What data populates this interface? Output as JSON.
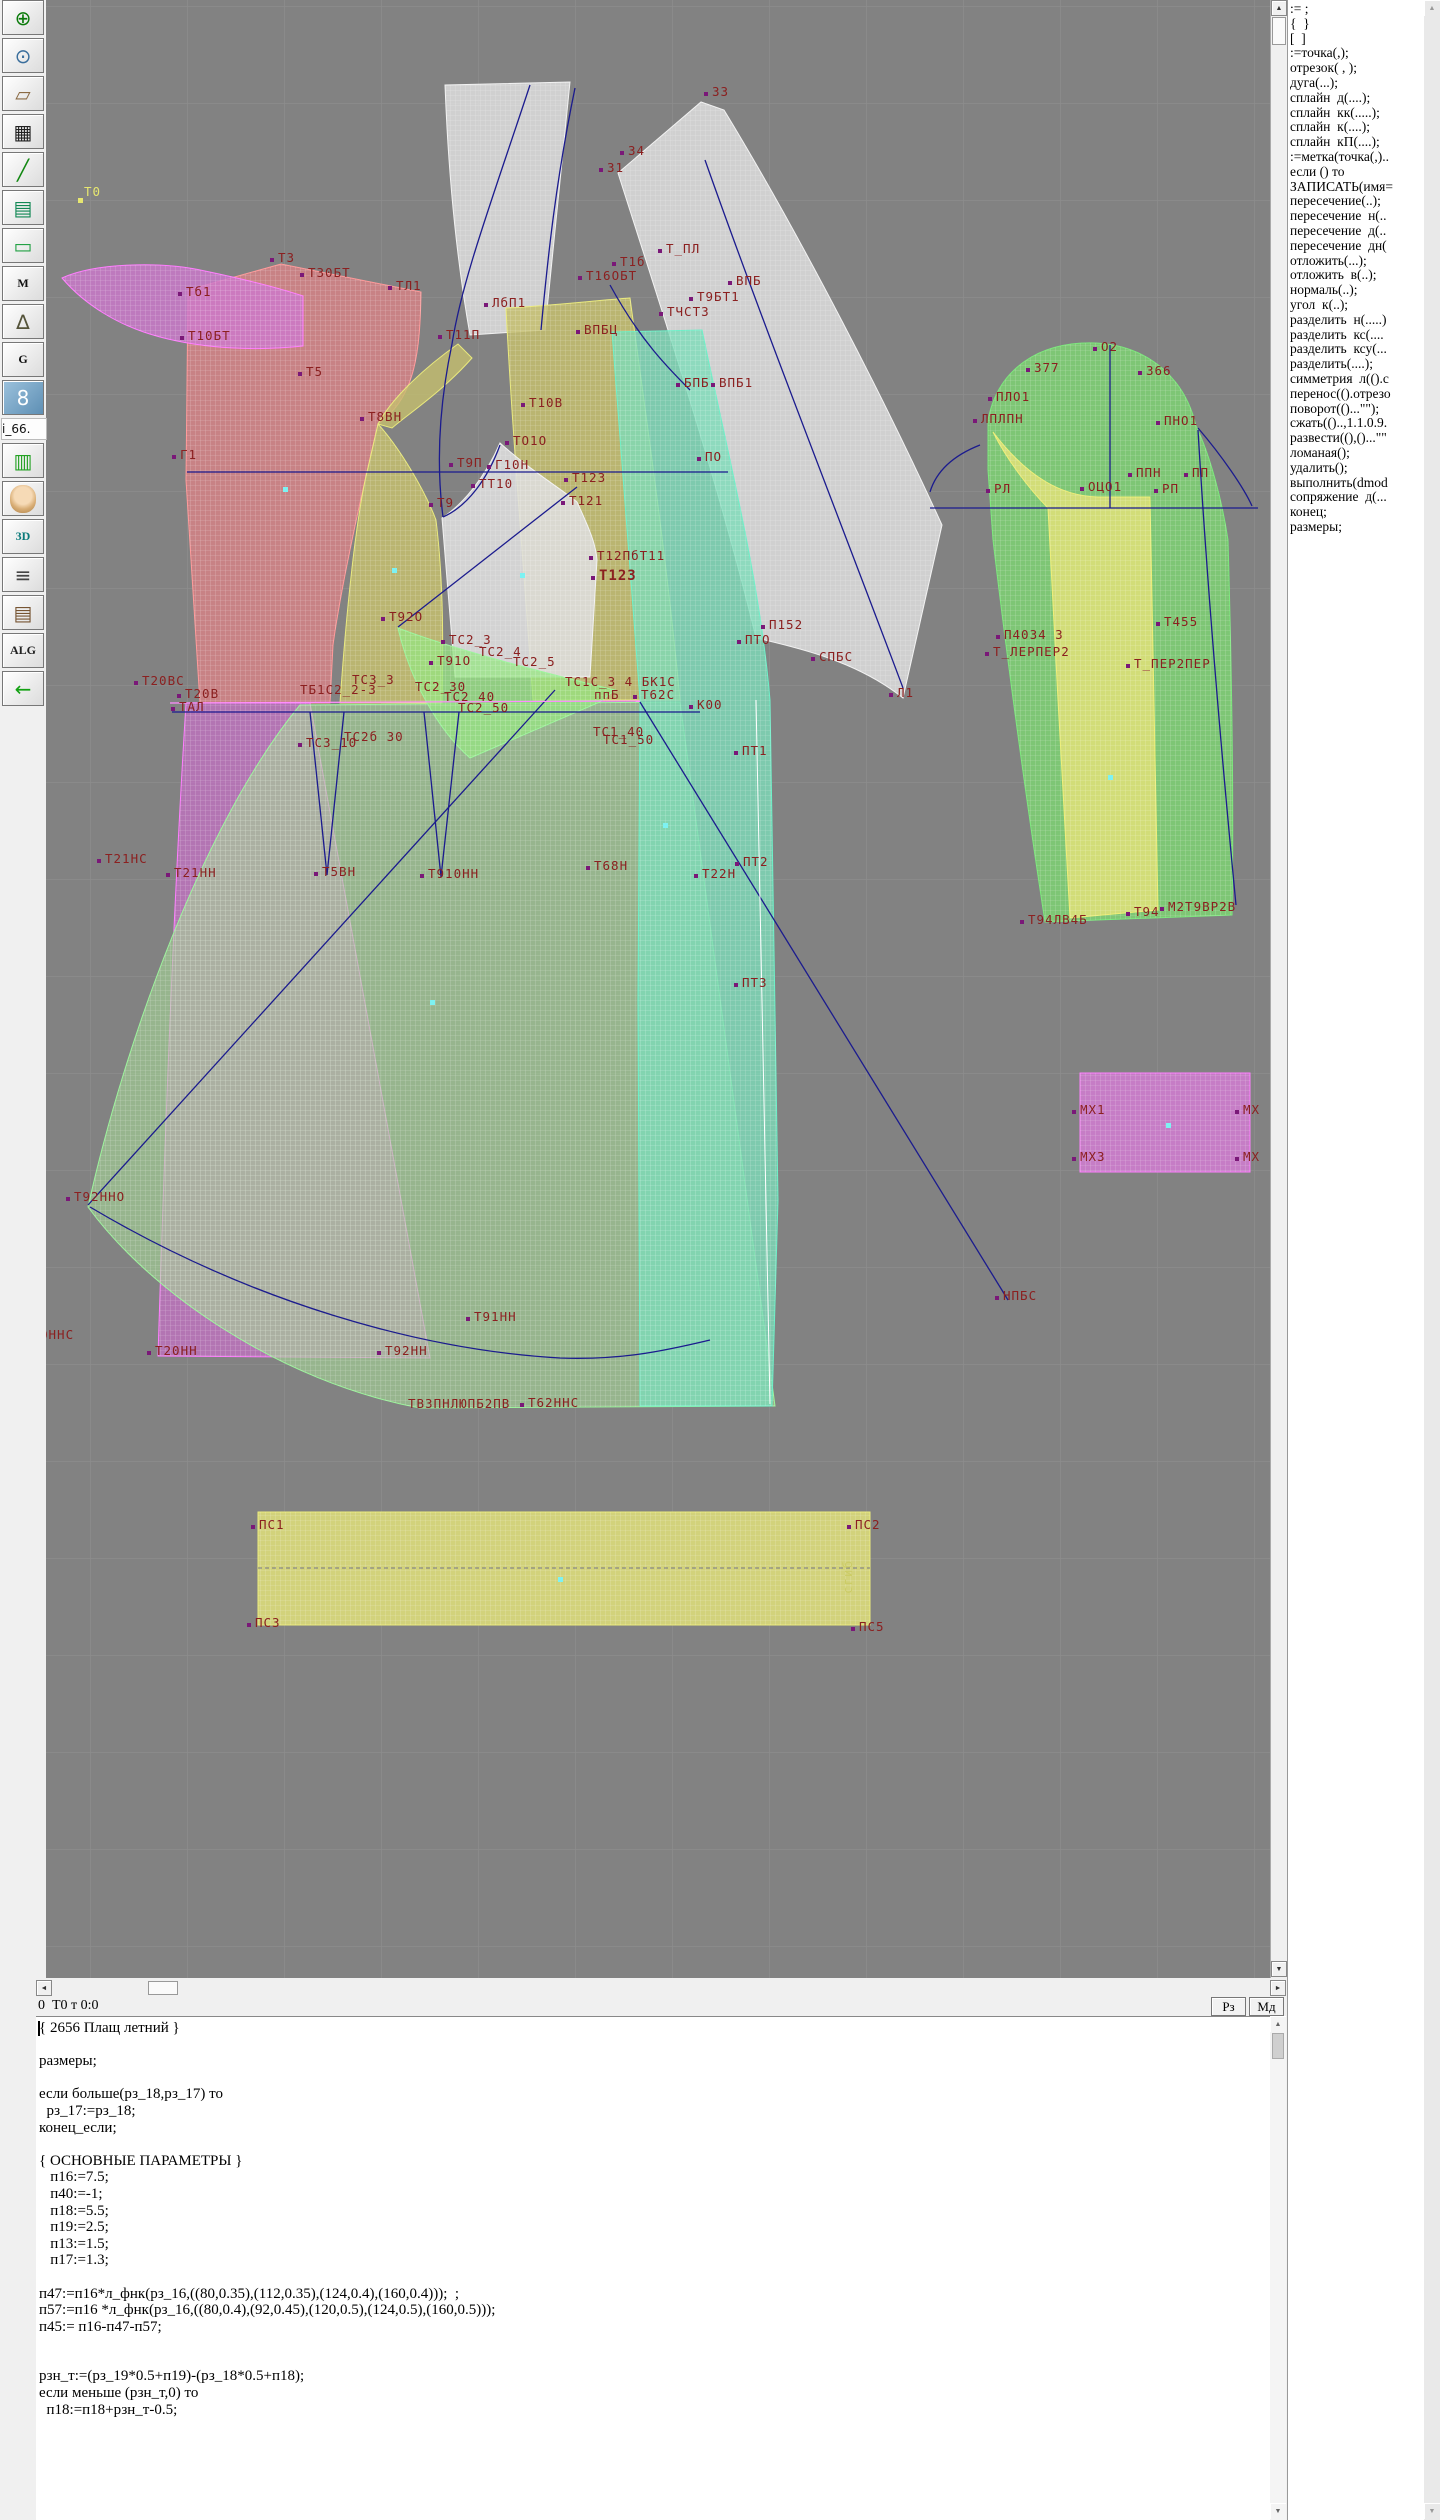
{
  "toolbar": {
    "items": [
      {
        "name": "zoom-in-icon",
        "glyph": "⊕",
        "color": "#0a7a0a"
      },
      {
        "name": "zoom-out-icon",
        "glyph": "⊙",
        "color": "#3a6e9c"
      },
      {
        "name": "label-tag-icon",
        "glyph": "▱",
        "color": "#8a6a44"
      },
      {
        "name": "grid-icon",
        "glyph": "▦",
        "color": "#222222"
      },
      {
        "name": "segment-icon",
        "glyph": "╱",
        "color": "#128812"
      },
      {
        "name": "document-chart-icon",
        "glyph": "▤",
        "color": "#128855"
      },
      {
        "name": "pattern-tag-icon",
        "glyph": "▭",
        "color": "#23a145"
      },
      {
        "name": "m-module-icon",
        "glyph": "M",
        "color": "#111111",
        "serif": true
      },
      {
        "name": "drafting-compass-icon",
        "glyph": "∆",
        "color": "#55543a"
      },
      {
        "name": "g-module-icon",
        "glyph": "G",
        "color": "#111111",
        "serif": true
      },
      {
        "name": "ruler-8-icon",
        "glyph": "8",
        "color": "#ffffff",
        "ruler": true
      },
      {
        "name": "i66-label",
        "text": "i_66."
      },
      {
        "name": "table-icon",
        "glyph": "▥",
        "color": "#23a123"
      },
      {
        "name": "portrait-icon",
        "face": true
      },
      {
        "name": "threed-icon",
        "glyph": "3D",
        "color": "#0a7a7a",
        "small": true
      },
      {
        "name": "text-list-icon",
        "glyph": "≡",
        "color": "#444444"
      },
      {
        "name": "books-icon",
        "glyph": "▤",
        "color": "#775533"
      },
      {
        "name": "alg-icon",
        "glyph": "ALG",
        "color": "#222222",
        "small": true
      },
      {
        "name": "exit-arrow-icon",
        "glyph": "←",
        "color": "#12a112"
      }
    ]
  },
  "canvas": {
    "background": "#828282",
    "grid_color": "#8d8d8d",
    "grid_step": 97,
    "label_color": "#8b2020",
    "marker_color": "#7a1878",
    "cyan_color": "#7df2f2",
    "labels": [
      {
        "t": "Т0",
        "x": 84,
        "y": 196,
        "c": "#e6e670"
      },
      {
        "t": "Т3",
        "x": 278,
        "y": 262,
        "m": 1
      },
      {
        "t": "Т30БТ",
        "x": 308,
        "y": 277,
        "m": 1
      },
      {
        "t": "ТЛ1",
        "x": 396,
        "y": 290,
        "m": 1
      },
      {
        "t": "Тб1",
        "x": 186,
        "y": 296,
        "m": 1
      },
      {
        "t": "Т10БТ",
        "x": 188,
        "y": 340,
        "m": 1
      },
      {
        "t": "Т5",
        "x": 306,
        "y": 376,
        "m": 1
      },
      {
        "t": "33",
        "x": 712,
        "y": 96,
        "m": 1
      },
      {
        "t": "34",
        "x": 628,
        "y": 155,
        "m": 1
      },
      {
        "t": "31",
        "x": 607,
        "y": 172,
        "m": 1
      },
      {
        "t": "Т_ПЛ",
        "x": 666,
        "y": 253,
        "m": 1
      },
      {
        "t": "Т1б",
        "x": 620,
        "y": 266,
        "m": 1
      },
      {
        "t": "Т16ОБТ",
        "x": 586,
        "y": 280,
        "m": 1
      },
      {
        "t": "ВПБ",
        "x": 736,
        "y": 285,
        "m": 1
      },
      {
        "t": "Т9БТ1",
        "x": 697,
        "y": 301,
        "m": 1
      },
      {
        "t": "ТЧСТ3",
        "x": 667,
        "y": 316,
        "m": 1
      },
      {
        "t": "ЛбП1",
        "x": 492,
        "y": 307,
        "m": 1
      },
      {
        "t": "Т11П",
        "x": 446,
        "y": 339,
        "m": 1
      },
      {
        "t": "ВПБЦ",
        "x": 584,
        "y": 334,
        "m": 1
      },
      {
        "t": "БПБ",
        "x": 684,
        "y": 387,
        "m": 1
      },
      {
        "t": "ВПБ1",
        "x": 719,
        "y": 387,
        "m": 1
      },
      {
        "t": "Т10В",
        "x": 529,
        "y": 407,
        "m": 1
      },
      {
        "t": "ТО1О",
        "x": 513,
        "y": 445,
        "m": 1
      },
      {
        "t": "Т8ВН",
        "x": 368,
        "y": 421,
        "m": 1
      },
      {
        "t": "Г1",
        "x": 180,
        "y": 459,
        "m": 1
      },
      {
        "t": "Т9П",
        "x": 457,
        "y": 467,
        "m": 1
      },
      {
        "t": "Г10Н",
        "x": 495,
        "y": 469,
        "m": 1
      },
      {
        "t": "ТТ10",
        "x": 479,
        "y": 488,
        "m": 1
      },
      {
        "t": "Т9",
        "x": 437,
        "y": 507,
        "m": 1
      },
      {
        "t": "Т123",
        "x": 572,
        "y": 482,
        "m": 1
      },
      {
        "t": "Т121",
        "x": 569,
        "y": 505,
        "m": 1
      },
      {
        "t": "ПО",
        "x": 705,
        "y": 461,
        "m": 1
      },
      {
        "t": "Т12ПбТ11",
        "x": 597,
        "y": 560,
        "m": 1
      },
      {
        "t": "Т123",
        "x": 599,
        "y": 580,
        "b": 1,
        "m": 1
      },
      {
        "t": "Т92О",
        "x": 389,
        "y": 621,
        "m": 1
      },
      {
        "t": "ТС2_3",
        "x": 449,
        "y": 644,
        "m": 1
      },
      {
        "t": "ТС2_4",
        "x": 479,
        "y": 656
      },
      {
        "t": "Т91О",
        "x": 437,
        "y": 665,
        "m": 1
      },
      {
        "t": "ТС2_5",
        "x": 513,
        "y": 666
      },
      {
        "t": "П152",
        "x": 769,
        "y": 629,
        "m": 1
      },
      {
        "t": "ПТО",
        "x": 745,
        "y": 644,
        "m": 1
      },
      {
        "t": "СПБС",
        "x": 819,
        "y": 661,
        "m": 1
      },
      {
        "t": "Л1",
        "x": 897,
        "y": 697,
        "m": 1
      },
      {
        "t": "ТБ1С2_2-3",
        "x": 300,
        "y": 694
      },
      {
        "t": "ТС3_3",
        "x": 352,
        "y": 684
      },
      {
        "t": "ТС2_30",
        "x": 415,
        "y": 691
      },
      {
        "t": "ТС2_40",
        "x": 444,
        "y": 701
      },
      {
        "t": "ТС2_50",
        "x": 458,
        "y": 712
      },
      {
        "t": "ТС1С_3 4 БК1С",
        "x": 565,
        "y": 686
      },
      {
        "t": "ппБ",
        "x": 594,
        "y": 699
      },
      {
        "t": "Т62С",
        "x": 641,
        "y": 699,
        "m": 1
      },
      {
        "t": "К00",
        "x": 697,
        "y": 709,
        "m": 1
      },
      {
        "t": "ТС1_40",
        "x": 593,
        "y": 736
      },
      {
        "t": "ТС1_50",
        "x": 603,
        "y": 744
      },
      {
        "t": "ПТ1",
        "x": 742,
        "y": 755,
        "m": 1
      },
      {
        "t": "Т20ВС",
        "x": 142,
        "y": 685,
        "m": 1
      },
      {
        "t": "Т20В",
        "x": 185,
        "y": 698,
        "m": 1
      },
      {
        "t": "ТАЛ",
        "x": 179,
        "y": 711,
        "m": 1
      },
      {
        "t": "ТС3_10",
        "x": 306,
        "y": 747,
        "m": 1
      },
      {
        "t": "ТС2б 30",
        "x": 344,
        "y": 741
      },
      {
        "t": "Т21НС",
        "x": 105,
        "y": 863,
        "m": 1
      },
      {
        "t": "Т21НН",
        "x": 174,
        "y": 877,
        "m": 1
      },
      {
        "t": "Т5ВН",
        "x": 322,
        "y": 876,
        "m": 1
      },
      {
        "t": "Т910НН",
        "x": 428,
        "y": 878,
        "m": 1
      },
      {
        "t": "Т68Н",
        "x": 594,
        "y": 870,
        "m": 1
      },
      {
        "t": "Т22Н",
        "x": 702,
        "y": 878,
        "m": 1
      },
      {
        "t": "ПТ2",
        "x": 743,
        "y": 866,
        "m": 1
      },
      {
        "t": "ПТ3",
        "x": 742,
        "y": 987,
        "m": 1
      },
      {
        "t": "Т92ННО",
        "x": 74,
        "y": 1201,
        "m": 1
      },
      {
        "t": "ОННС",
        "x": 40,
        "y": 1339
      },
      {
        "t": "Т20НН",
        "x": 155,
        "y": 1355,
        "m": 1
      },
      {
        "t": "Т92НН",
        "x": 385,
        "y": 1355,
        "m": 1
      },
      {
        "t": "Т91НН",
        "x": 474,
        "y": 1321,
        "m": 1
      },
      {
        "t": "ТВЗПНЛЮПБ2ПВ",
        "x": 408,
        "y": 1408
      },
      {
        "t": "Т62ННС",
        "x": 528,
        "y": 1407,
        "m": 1
      },
      {
        "t": "НПБС",
        "x": 1003,
        "y": 1300,
        "m": 1
      },
      {
        "t": "МХ1",
        "x": 1080,
        "y": 1114,
        "m": 1
      },
      {
        "t": "МХ3",
        "x": 1080,
        "y": 1161,
        "m": 1
      },
      {
        "t": "МХ",
        "x": 1243,
        "y": 1114,
        "m": 1
      },
      {
        "t": "МХ",
        "x": 1243,
        "y": 1161,
        "m": 1
      },
      {
        "t": "ПС1",
        "x": 259,
        "y": 1529,
        "m": 1
      },
      {
        "t": "ПС2",
        "x": 855,
        "y": 1529,
        "m": 1
      },
      {
        "t": "ПС3",
        "x": 255,
        "y": 1627,
        "m": 1
      },
      {
        "t": "ПС5",
        "x": 859,
        "y": 1631,
        "m": 1
      },
      {
        "t": "сгиб",
        "x": 852,
        "y": 1594,
        "c": "#cccc66",
        "rot": -90
      },
      {
        "t": "О2",
        "x": 1101,
        "y": 351,
        "m": 1
      },
      {
        "t": "377",
        "x": 1034,
        "y": 372,
        "m": 1
      },
      {
        "t": "366",
        "x": 1146,
        "y": 375,
        "m": 1
      },
      {
        "t": "ПЛО1",
        "x": 996,
        "y": 401,
        "m": 1
      },
      {
        "t": "ЛПЛПН",
        "x": 981,
        "y": 423,
        "m": 1
      },
      {
        "t": "ПНО1",
        "x": 1164,
        "y": 425,
        "m": 1
      },
      {
        "t": "ППН",
        "x": 1136,
        "y": 477,
        "m": 1
      },
      {
        "t": "ПП",
        "x": 1192,
        "y": 477,
        "m": 1
      },
      {
        "t": "РЛ",
        "x": 994,
        "y": 493,
        "m": 1
      },
      {
        "t": "ОЦО1",
        "x": 1088,
        "y": 491,
        "m": 1
      },
      {
        "t": "РП",
        "x": 1162,
        "y": 493,
        "m": 1
      },
      {
        "t": "Т455",
        "x": 1164,
        "y": 626,
        "m": 1
      },
      {
        "t": "П4034 3",
        "x": 1004,
        "y": 639,
        "m": 1
      },
      {
        "t": "Т_ЛЕРПЕР2",
        "x": 993,
        "y": 656,
        "m": 1
      },
      {
        "t": "Т_ПЕР2ПЕР",
        "x": 1134,
        "y": 668,
        "m": 1
      },
      {
        "t": "Т94ЛВ4Б",
        "x": 1028,
        "y": 924,
        "m": 1
      },
      {
        "t": "Т94",
        "x": 1134,
        "y": 916,
        "m": 1
      },
      {
        "t": "М2Т9ВР2В",
        "x": 1168,
        "y": 911,
        "m": 1
      }
    ],
    "yellow_point": [
      78,
      198
    ],
    "cyan_points": [
      [
        283,
        487
      ],
      [
        392,
        568
      ],
      [
        520,
        573
      ],
      [
        663,
        823
      ],
      [
        430,
        1000
      ],
      [
        1108,
        775
      ],
      [
        1166,
        1123
      ],
      [
        558,
        1577
      ]
    ]
  },
  "right_panel": {
    "commands": [
      ":= ;",
      "{  }",
      "[  ]",
      ":=точка(,);",
      "отрезок( , );",
      "дуга(...);",
      "сплайн  д(....);",
      "сплайн  кк(.....);",
      "сплайн  к(....);",
      "сплайн  кП(....);",
      ":=метка(точка(,)..",
      "если () то",
      "ЗАПИСАТЬ(имя=",
      "пересечение(..);",
      "пересечение  н(..",
      "пересечение  д(..",
      "пересечение  дн(",
      "отложить(...);",
      "отложить  в(..);",
      "нормаль(..);",
      "угол  к(..);",
      "разделить  н(.....)",
      "разделить  кс(....",
      "разделить  ксу(...",
      "разделить(....);",
      "симметрия  л(().с",
      "перенос(().отрезо",
      "поворот(()...\"\");",
      "сжать(()..,1.1.0.9.",
      "развести((),()...\"\"",
      "ломаная();",
      "удалить();",
      "выполнить(dmod",
      "сопряжение  д(...",
      "конец;",
      "размеры;"
    ]
  },
  "status_bar": {
    "text": "0  Т0 т 0:0",
    "btn_rz": "Рз",
    "btn_md": "Мд"
  },
  "editor": {
    "lines": [
      "{ 2656 Плащ летний }",
      "",
      "размеры;",
      "",
      "если больше(рз_18,рз_17) то",
      "  рз_17:=рз_18;",
      "конец_если;",
      "",
      "{ ОСНОВНЫЕ ПАРАМЕТРЫ }",
      "   п16:=7.5;",
      "   п40:=-1;",
      "   п18:=5.5;",
      "   п19:=2.5;",
      "   п13:=1.5;",
      "   п17:=1.3;",
      "",
      "п47:=п16*л_фнк(рз_16,((80,0.35),(112,0.35),(124,0.4),(160,0.4)));  ;",
      "п57:=п16 *л_фнк(рз_16,((80,0.4),(92,0.45),(120,0.5),(124,0.5),(160,0.5)));",
      "п45:= п16-п47-п57;",
      "",
      "",
      "рзн_т:=(рз_19*0.5+п19)-(рз_18*0.5+п18);",
      "если меньше (рзн_т,0) то",
      "  п18:=п18+рзн_т-0.5;"
    ]
  }
}
